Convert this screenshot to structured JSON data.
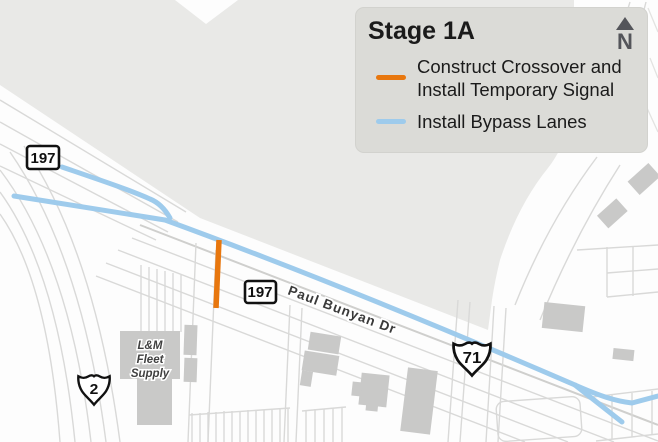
{
  "legend": {
    "title": "Stage 1A",
    "north_label": "N",
    "items": [
      {
        "id": "construct-crossover",
        "color": "#E8770E",
        "line1": "Construct Crossover and",
        "line2": "Install Temporary Signal"
      },
      {
        "id": "install-bypass-lanes",
        "color": "#9ECBEC",
        "line1": "Install Bypass Lanes"
      }
    ]
  },
  "map": {
    "shields": {
      "route197_west": "197",
      "route197_east": "197",
      "us2": "2",
      "us71": "71"
    },
    "labels": {
      "road": "Paul Bunyan Dr",
      "business_line1": "L&M",
      "business_line2": "Fleet",
      "business_line3": "Supply"
    },
    "colors": {
      "crossover": "#E8770E",
      "bypass": "#9ECBEC",
      "land": "#E9E9E7",
      "road_line": "#D9D9D8",
      "building": "#C9C9C8",
      "north_arrow": "#54555A"
    }
  }
}
